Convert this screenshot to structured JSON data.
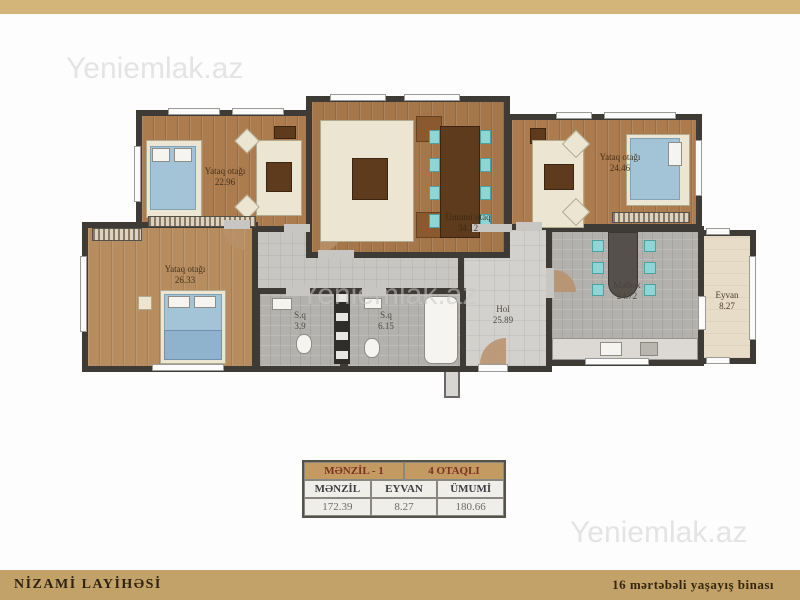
{
  "watermark": {
    "text": "Yeniemlak.az"
  },
  "plan": {
    "rooms": [
      {
        "name": "Yataq otağı",
        "area": "22.96"
      },
      {
        "name": "Ümumi otaq",
        "area": "34.12"
      },
      {
        "name": "Yataq otağı",
        "area": "24.46"
      },
      {
        "name": "Yataq otağı",
        "area": "26.33"
      },
      {
        "name": "S.q",
        "area": "3.9"
      },
      {
        "name": "S.q",
        "area": "6.15"
      },
      {
        "name": "Hol",
        "area": "25.89"
      },
      {
        "name": "Mətbəx",
        "area": "24.72"
      },
      {
        "name": "Eyvan",
        "area": "8.27"
      }
    ]
  },
  "table": {
    "title_left": "MƏNZİL - 1",
    "title_right": "4 OTAQLI",
    "columns": [
      "MƏNZİL",
      "EYVAN",
      "ÜMUMİ"
    ],
    "values": [
      "172.39",
      "8.27",
      "180.66"
    ]
  },
  "footer": {
    "left": "NİZAMİ LAYİHƏSİ",
    "right": "16 mərtəbəli yaşayış binası"
  },
  "colors": {
    "band_top": "#d3b57a",
    "band_bottom": "#c2a268",
    "wall": "#3e3b37",
    "wood": "#ab7b4e",
    "tile": "#b3b1ae",
    "chair_teal": "#8ed6d6",
    "table_header": "#c49a63",
    "watermark_gray": "#e4e4e4"
  }
}
